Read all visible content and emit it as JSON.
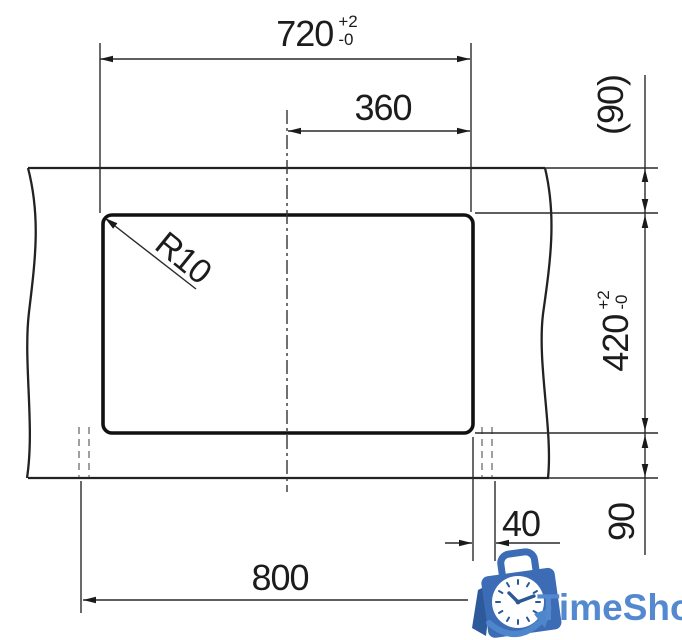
{
  "dimensions": {
    "cutout_width": {
      "value": "720",
      "tol_plus": "+2",
      "tol_minus": "-0"
    },
    "center_offset": {
      "value": "360"
    },
    "top_offset": {
      "value": "(90)"
    },
    "cutout_height": {
      "value": "420",
      "tol_plus": "+2",
      "tol_minus": "-0"
    },
    "corner_radius": {
      "value": "R10"
    },
    "edge_overhang": {
      "value": "40"
    },
    "bottom_offset": {
      "value": "90"
    },
    "total_width": {
      "value": "800"
    }
  },
  "logo": {
    "brand": "TimeShop"
  },
  "colors": {
    "drawing_line": "#2a2a2a",
    "cutout_line": "#111111",
    "worktop_line": "#222222",
    "hidden_line": "#8f8f8f",
    "logo_bag": "#3c6cb5",
    "logo_flap": "#2d5a9b",
    "logo_clock_marks": "#2d5897",
    "logo_swoosh": "#4e86cb",
    "logo_text": "#5488cf"
  }
}
